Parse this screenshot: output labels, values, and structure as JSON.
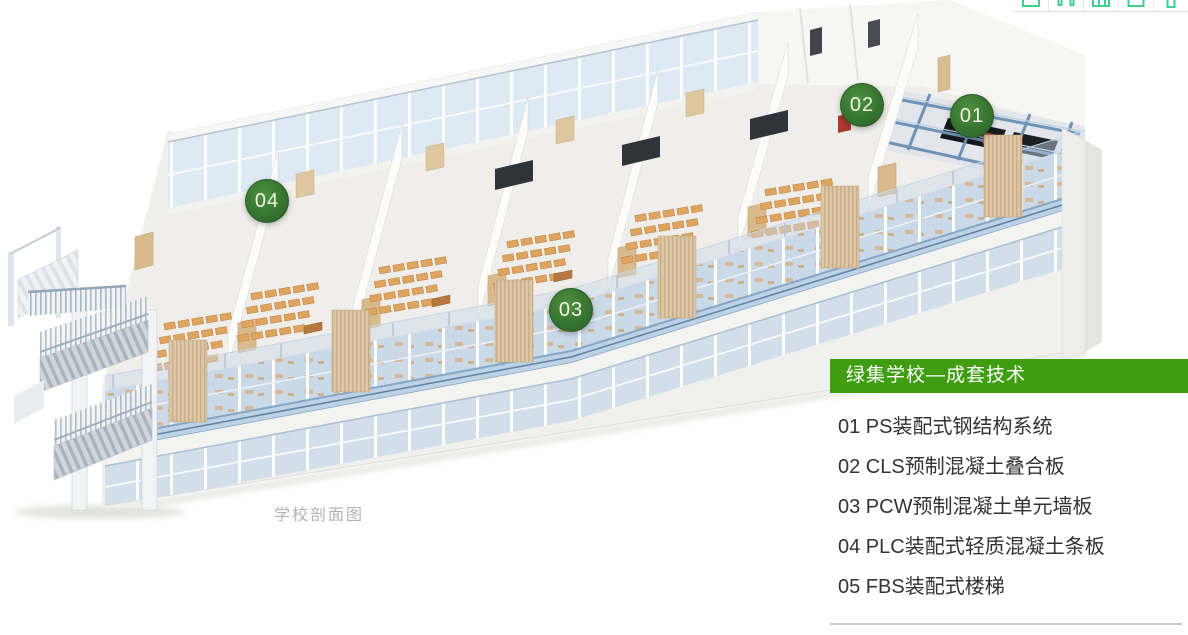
{
  "toolbar": {
    "icons": [
      "monitor-icon",
      "contacts-icon",
      "grid-icon",
      "mail-icon",
      "phone-icon"
    ],
    "icon_color": "#3ecf8e"
  },
  "scene": {
    "caption": "学校剖面图",
    "markers": [
      "01",
      "02",
      "03",
      "04"
    ]
  },
  "panel": {
    "title": "绿集学校—成套技术",
    "items": [
      "01 PS装配式钢结构系统",
      "02 CLS预制混凝土叠合板",
      "03 PCW预制混凝土单元墙板",
      "04 PLC装配式轻质混凝土条板",
      "05 FBS装配式楼梯"
    ],
    "accent_color": "#3e9d10",
    "text_color": "#333333",
    "caption_color": "#b3b3b3",
    "marker_color": "#2e6a2b"
  }
}
